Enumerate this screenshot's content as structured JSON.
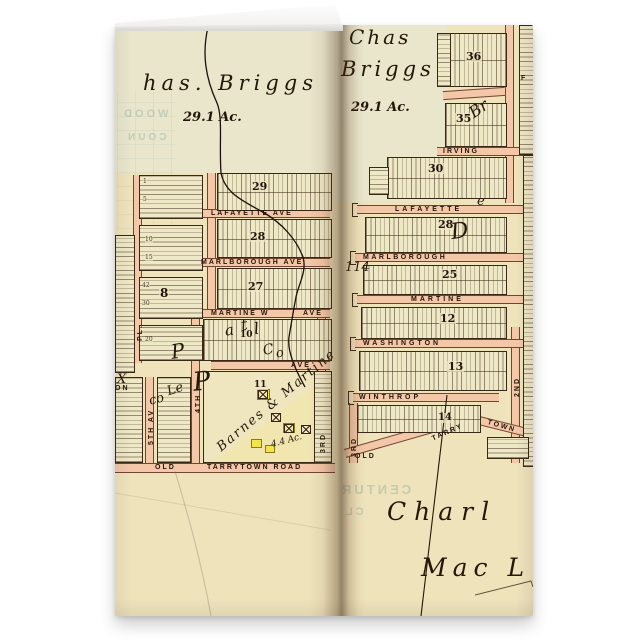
{
  "card": {
    "colors": {
      "paper": "#efe3bc",
      "street": "#f3c7a7",
      "ink": "#241708",
      "highlight_yellow": "#f2e44d"
    },
    "left_page": {
      "owner": "has. Briggs",
      "acreage": "29.1 Ac.",
      "streets": {
        "lafayette": "LAFAYETTE AVE",
        "marlborough": "MARLBOROUGH AVE",
        "martine": "MARTINE W",
        "martine_ave": "AVE",
        "ave": "AVE",
        "old": "OLD",
        "tarrytown_road": "TARRYTOWN ROAD",
        "pl": "PL.",
        "fifth": "5TH AV",
        "fourth": "4TH",
        "third": "3RD",
        "on_fragment": "ON"
      },
      "blocks": {
        "b29": "29",
        "b28": "28",
        "b27": "27",
        "b8": "8",
        "b11": "11",
        "b10": "10"
      },
      "lots": [
        "1",
        "5",
        "10",
        "15",
        "20",
        "42",
        "30"
      ],
      "script": [
        "P",
        "P",
        "a",
        "t",
        "l",
        "C",
        "o",
        "co",
        "Le",
        "X"
      ],
      "subdivision": {
        "name": "Barnes & Martine",
        "acreage": "4.4 Ac."
      },
      "bleed": [
        "WOOD",
        "COUN"
      ]
    },
    "right_page": {
      "owner_line1": "Chas",
      "owner_line2": "Briggs",
      "acreage": "29.1 Ac.",
      "streets": {
        "irving": "IRVING",
        "lafayette": "LAFAYETTE",
        "marlborough": "MARLBOROUGH",
        "martine": "MARTINE",
        "washington": "WASHINGTON",
        "winthrop": "WINTHROP",
        "old": "OLD",
        "tarry": "TARRY",
        "town": "TOWN",
        "third": "3RD",
        "second": "2ND",
        "f_fragment": "F"
      },
      "blocks": {
        "b36": "36",
        "b35": "35",
        "b30": "30",
        "b28": "28",
        "b25": "25",
        "b12": "12",
        "b13": "13",
        "b14": "14"
      },
      "area_label": "114",
      "script": {
        "br": "Br",
        "d": "D",
        "e": "e"
      },
      "owner_bottom1": "Charl",
      "owner_bottom2": "Mac L",
      "bleed": [
        "CENTUR",
        "CL"
      ]
    }
  }
}
